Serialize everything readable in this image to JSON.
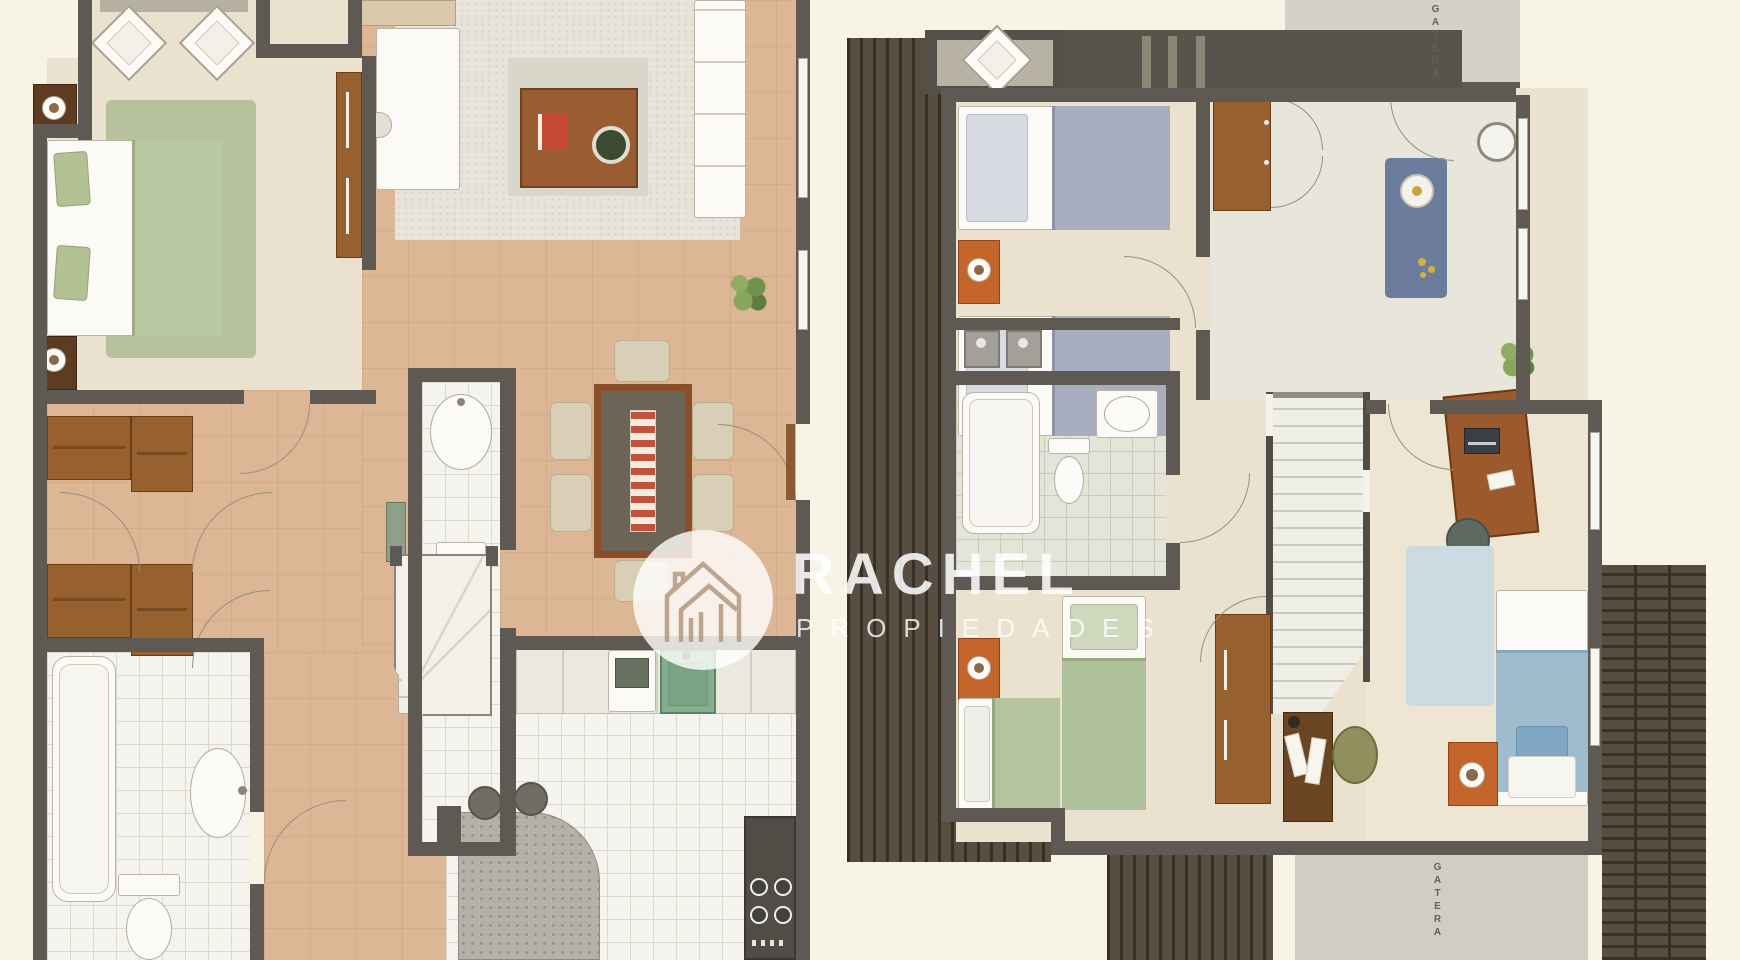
{
  "watermark": {
    "brand": "RACHEL",
    "subtitle": "PROPIEDADES",
    "logo": "houses-outline-icon"
  },
  "labels": {
    "gatera_top": "GATERA",
    "gatera_bottom": "GATERA"
  },
  "palette": {
    "background": "#f7f4e6",
    "wall": "#5f5954",
    "floor_beige": "#ebe1cf",
    "floor_wood": "#ddb795",
    "floor_tile": "#f4f3ed",
    "rug_speckled_gray": "#e7e4db",
    "rug_green": "#b7c29c",
    "rug_blue": "#6b7c9c",
    "rug_light_blue": "#ccdbe2",
    "deck_brown": "#574d40",
    "gatera_gray": "#d3d1c8",
    "furniture_brown": "#96602f",
    "nightstand_orange": "#c4662c",
    "blanket_green": "#b5c49c",
    "blanket_blue_gray": "#a8adc0",
    "blanket_blue": "#9fbccd",
    "accent_red": "#c64a33",
    "plant_green": "#6f934f",
    "watermark_white": "rgba(255,255,255,0.84)"
  }
}
